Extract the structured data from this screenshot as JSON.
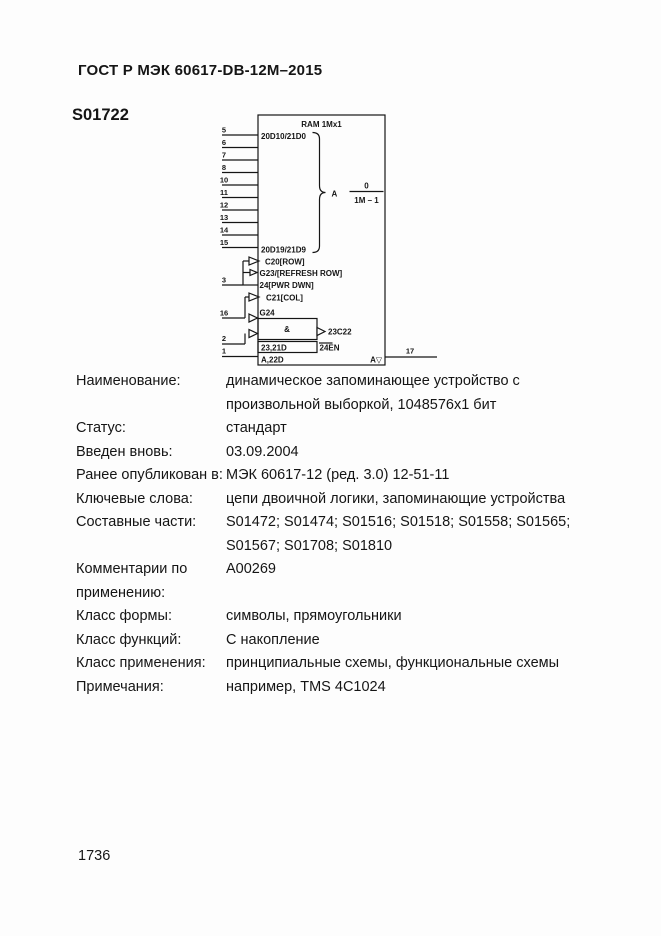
{
  "page": {
    "header": "ГОСТ Р МЭК 60617-DB-12M–2015",
    "symbol_id": "S01722",
    "page_number": "1736"
  },
  "diagram": {
    "title": "RAM 1Mx1",
    "address_pins": [
      "5",
      "6",
      "7",
      "8",
      "10",
      "11",
      "12",
      "13",
      "14",
      "15"
    ],
    "address_top_label": "20D10/21D0",
    "address_bottom_label": "20D19/21D9",
    "address_group_letter": "A",
    "address_range_top": "0",
    "address_range_bottom": "1M – 1",
    "row_pin": "3",
    "row_label_1": "C20[ROW]",
    "row_label_2": "G23/[REFRESH ROW]",
    "row_label_3": "24[PWR DWN]",
    "col_pin": "16",
    "col_label_1": "C21[COL]",
    "col_label_2": "G24",
    "and_label": "&",
    "and_output_label": "23C22",
    "write_pin": "2",
    "write_label": "23,21D",
    "enable_label": "24EN",
    "data_pin": "1",
    "data_input_label": "A,22D",
    "data_output_label": "A▽",
    "output_pin": "17"
  },
  "properties": [
    {
      "label": "Наименование:",
      "value": "динамическое запоминающее устройство с произвольной выборкой, 1048576x1 бит"
    },
    {
      "label": "Статус:",
      "value": "стандарт"
    },
    {
      "label": "Введен вновь:",
      "value": "03.09.2004"
    },
    {
      "label": "Ранее опубликован в:",
      "value": "МЭК 60617-12 (ред. 3.0) 12-51-11"
    },
    {
      "label": "Ключевые слова:",
      "value": "цепи двоичной логики, запоминающие устройства"
    },
    {
      "label": "Составные части:",
      "value": "S01472; S01474; S01516; S01518; S01558; S01565; S01567; S01708; S01810"
    },
    {
      "label": "Комментарии по применению:",
      "value": "A00269"
    },
    {
      "label": "Класс формы:",
      "value": "символы, прямоугольники"
    },
    {
      "label": "Класс функций:",
      "value": "С накопление"
    },
    {
      "label": "Класс применения:",
      "value": "принципиальные схемы, функциональные схемы"
    },
    {
      "label": "Примечания:",
      "value": "например, TMS 4C1024"
    }
  ]
}
